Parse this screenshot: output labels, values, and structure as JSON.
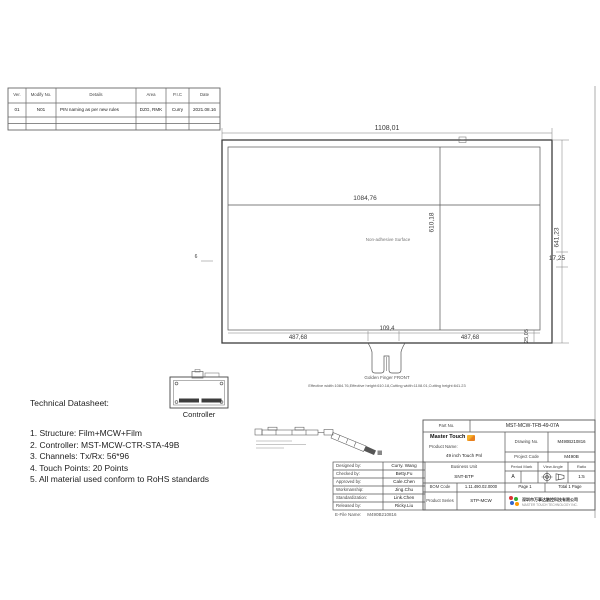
{
  "revision_table": {
    "headers": [
      "Ver.",
      "Modify No.",
      "Details",
      "Area",
      "P.I.C",
      "Date"
    ],
    "row": [
      "01",
      "N01",
      "PIN naming as per new rules",
      "DZG, RMK",
      "Curry",
      "2021.08.16"
    ]
  },
  "drawing": {
    "cutting_width": "1108,01",
    "effective_width": "1084,76",
    "effective_height": "610,18",
    "cutting_height": "641,23",
    "right_border": "17,25",
    "bottom_border": "25,05",
    "left_border": "6",
    "bottom_left_width": "487,68",
    "tail_width": "109,4",
    "bottom_right_width": "487,68",
    "surface_label": "Non-adhesive Surface",
    "tail_label": "Golden Finger FRONT",
    "note": "Effective width:1084.76,Effective height:610.18,Cutting width:1108.01,Cutting height:641.23",
    "controller_label": "Controller"
  },
  "datasheet": {
    "title": "Technical Datasheet:",
    "items": [
      "1. Structure: Film+MCW+Film",
      "2. Controller: MST-MCW-CTR-STA-49B",
      "3. Channels: Tx/Rx: 56*96",
      "4. Touch Points: 20 Points",
      "5. All material used conform to RoHS standards"
    ]
  },
  "title_block": {
    "part_no_label": "Part No.",
    "part_no": "MST-MCW-TFB-49-07A",
    "brand": "Master Touch",
    "product_name_label": "Product Name:",
    "product_name": "49 inch Touch Pnl",
    "drawing_no_label": "Drawing No.",
    "drawing_no": "M490B210816",
    "project_code_label": "Project Code",
    "project_code": "M490B",
    "business_unit_label": "Business Unit",
    "business_unit": "SNT-BTP",
    "period_mark_label": "Period Mark",
    "period_mark": "A",
    "view_angle_label": "View Angle",
    "ratio_label": "Ratio",
    "ratio": "1:5",
    "bom_code_label": "BOM Code",
    "bom_code": "1.11.490.02.0000",
    "page": "Page 1",
    "total_page": "Total 1 Page",
    "product_series_label": "Product Series",
    "product_series": "STP-MCW",
    "company_cn": "深圳市万事达触控科技有限公司",
    "company_en": "MASTER TOUCH TECHNOLOGY INC.",
    "people": [
      {
        "role": "Designed by:",
        "name": "Curry. Wang"
      },
      {
        "role": "Checked by:",
        "name": "Betty.Fu"
      },
      {
        "role": "Approved by:",
        "name": "Cale.Chen"
      },
      {
        "role": "Workmanship:",
        "name": "Jing.Chu"
      },
      {
        "role": "Standardization:",
        "name": "Link.Chen"
      },
      {
        "role": "Released by:",
        "name": "Ricky.Liu"
      }
    ],
    "efile_label": "E-File Name:",
    "efile_name": "M490B210816"
  }
}
